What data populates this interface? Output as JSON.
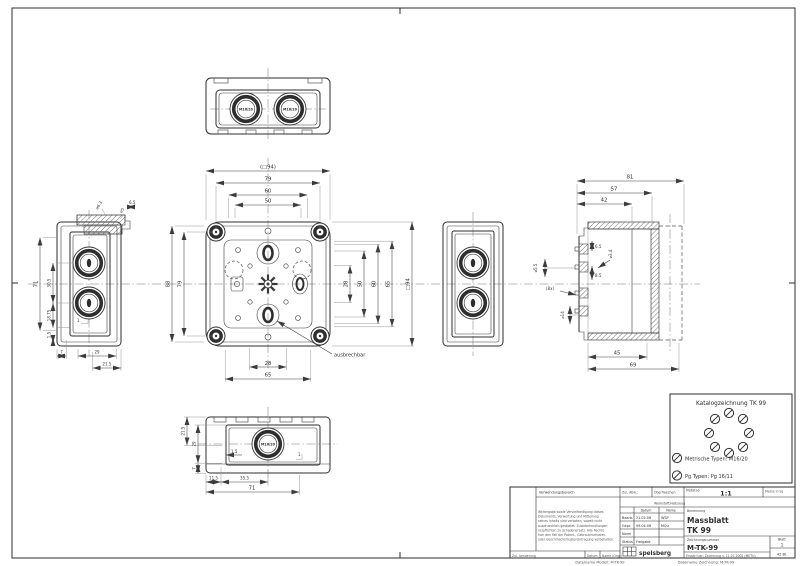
{
  "colors": {
    "line": "#2e2e2e",
    "dim_text": "#333333",
    "background": "#ffffff"
  },
  "frame": {
    "model_file": "Dateiname Modell: M-TK-99",
    "drawing_file": "Dateiname Zeichnung: M-TK-99"
  },
  "top_view": {
    "knockout_left": "M16/20",
    "knockout_right": "M16/20"
  },
  "main_view": {
    "dim_top_ref": "(□94)",
    "dim_top_79": "79",
    "dim_top_60": "60",
    "dim_top_50": "50",
    "dim_left_88": "88",
    "dim_left_79": "79",
    "dim_right_28": "28",
    "dim_right_50": "50",
    "dim_right_60": "60",
    "dim_right_65": "65",
    "dim_right_ref": "□94",
    "dim_bottom_28": "28",
    "dim_bottom_65": "65",
    "note": "ausbrechbar"
  },
  "left_view": {
    "dim_d6_3": "⌀6.3",
    "dim_d5": "⌀5",
    "dim_6_5": "6.5",
    "dim_71": "71",
    "dim_30_5": "30.5",
    "dim_18_75": "18.75",
    "dim_1_5": "1.5",
    "dim_1": "1",
    "dim_7": "7",
    "dim_29": "29",
    "dim_21_5": "21.5"
  },
  "section_view": {
    "dim_81": "81",
    "dim_57": "57",
    "dim_42": "42",
    "dim_d5_5": "⌀5.5",
    "dim_6_5": "6.5",
    "dim_d3_4": "⌀3.4",
    "dim_8_5": "8.5",
    "dim_8x": "(8x)",
    "dim_d14": "⌀14",
    "dim_45": "45",
    "dim_69": "69"
  },
  "bottom_view": {
    "knockout": "M16/20",
    "dim_21_5": "21.5",
    "dim_29": "29",
    "dim_7": "7",
    "dim_1_5": "1.5",
    "dim_1": "1",
    "dim_11_5": "11.5",
    "dim_35_5": "35.5",
    "dim_71": "71"
  },
  "catalog_box": {
    "title": "Katalogzeichnung  TK 99",
    "metric_types": "Metrische Typen: M16/20",
    "pg_types": "Pg Typen: Pg 16/11"
  },
  "title_block": {
    "verwendungsbereich_label": "Verwendungsbereich",
    "zul_abw_label": "Zul. Abw.:",
    "oberflaechen_label": "Oberflaechen",
    "massstab_label": "Maßstab",
    "scale_value": "1:1",
    "masse_label": "Masse in kg",
    "werkstoff_label": "Werkstoff,Halbzeug",
    "legal_lines": [
      "Weitergabe sowie Vervielfaeltigung dieses",
      "Dokuments, Verwertung und Mitteilung",
      "seines Inhalts sind verboten, soweit nicht",
      "ausdruecklich gestattet. Zuwiderhandlungen",
      "verpflichten zu Schadenersatz. Alle Rechte",
      "fuer den Fall der Patent-, Gebrauchsmuster-",
      "oder Geschmacksmustereintragung vorbehalten."
    ],
    "datum_header": "Datum",
    "name_header": "Name",
    "bearb_label": "Bearb.",
    "bearb_date": "21.02.08",
    "bearb_name": "WSP",
    "gepr_label": "Gepr.",
    "gepr_date": "09.04.08",
    "gepr_name": "MQu",
    "norm_label": "Norm",
    "status_label": "Status",
    "status_value": "Freigabe",
    "benennung_label": "Benennung",
    "benennung_line1": "Massblatt",
    "benennung_line2": "TK 99",
    "zeichnungsnummer_label": "Zeichnungsnummer",
    "drawing_number": "M-TK-99",
    "blatt_label": "Blatt",
    "blatt_value": "1",
    "blatt_total": "42 Bl.",
    "ersatz_text": "Ersatz fuer: Zeichnung v. 11.07.2002 (METU)",
    "change_label": "Zul. Aenderung",
    "change_datum": "Datum",
    "change_name": "Name (Orig.)",
    "logo_text": "spelsberg"
  }
}
